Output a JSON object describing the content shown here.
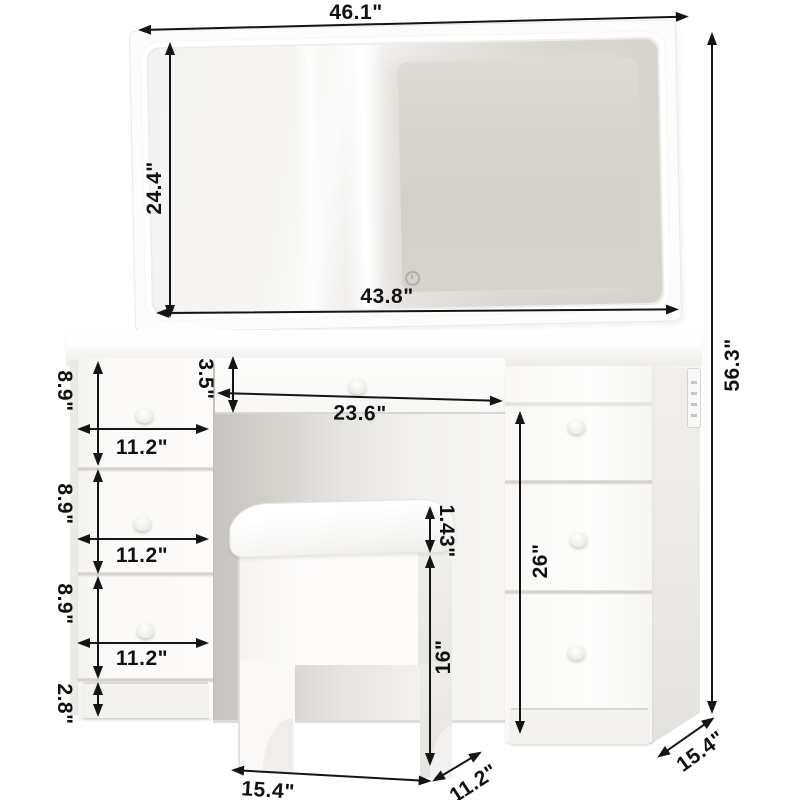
{
  "diagram": {
    "type": "furniture-dimension-diagram",
    "units": "inches"
  },
  "measurements": {
    "overall_width": "46.1\"",
    "overall_height": "56.3\"",
    "mirror_width": "43.8\"",
    "mirror_height": "24.4\"",
    "center_drawer_height": "3.5\"",
    "knee_space_width": "23.6\"",
    "left_drawer_height": "8.9\"",
    "left_drawer_width": "11.2\"",
    "left_base_height": "2.8\"",
    "right_unit_height": "26\"",
    "cushion_thickness": "1.43\"",
    "stool_height": "16\"",
    "stool_width": "15.4\"",
    "stool_depth": "11.2\"",
    "desk_depth": "15.4\""
  },
  "icons": {
    "mirror_touch": "power-touch-icon"
  },
  "colors": {
    "annotation": "#151515",
    "furniture_white": "#fbfaf9",
    "mirror_reflection": "#d6d2cc",
    "knee_shadow": "#c7c4c0"
  },
  "annotations": [
    {
      "id": "overall-width",
      "label": "46.1\"",
      "arrow": {
        "x": 139,
        "y": 30,
        "len": 549,
        "rot": -1.4
      },
      "text": {
        "x": 356,
        "y": 13,
        "rot": 0
      }
    },
    {
      "id": "mirror-height",
      "label": "24.4\"",
      "arrow": {
        "x": 170,
        "y": 43,
        "len": 274,
        "rot": 90
      },
      "text": {
        "x": 155,
        "y": 188,
        "rot": -90
      }
    },
    {
      "id": "mirror-width",
      "label": "43.8\"",
      "arrow": {
        "x": 157,
        "y": 313,
        "len": 521,
        "rot": -0.4
      },
      "text": {
        "x": 387,
        "y": 297,
        "rot": 0
      }
    },
    {
      "id": "center-drawer-height",
      "label": "3.5\"",
      "arrow": {
        "x": 233,
        "y": 357,
        "len": 55,
        "rot": 90
      },
      "text": {
        "x": 205,
        "y": 379,
        "rot": 90
      }
    },
    {
      "id": "knee-space-width",
      "label": "23.6\"",
      "arrow": {
        "x": 218,
        "y": 393,
        "len": 284,
        "rot": 1.6
      },
      "text": {
        "x": 360,
        "y": 414,
        "rot": 1
      }
    },
    {
      "id": "left-drawer1-height",
      "label": "8.9\"",
      "arrow": {
        "x": 98,
        "y": 362,
        "len": 103,
        "rot": 90
      },
      "text": {
        "x": 64,
        "y": 391,
        "rot": 90
      }
    },
    {
      "id": "left-drawer2-height",
      "label": "8.9\"",
      "arrow": {
        "x": 98,
        "y": 470,
        "len": 103,
        "rot": 90
      },
      "text": {
        "x": 64,
        "y": 504,
        "rot": 90
      }
    },
    {
      "id": "left-drawer3-height",
      "label": "8.9\"",
      "arrow": {
        "x": 98,
        "y": 577,
        "len": 101,
        "rot": 90
      },
      "text": {
        "x": 64,
        "y": 604,
        "rot": 90
      }
    },
    {
      "id": "left-base-height",
      "label": "2.8\"",
      "arrow": {
        "x": 98,
        "y": 683,
        "len": 33,
        "rot": 90
      },
      "text": {
        "x": 64,
        "y": 704,
        "rot": 90
      }
    },
    {
      "id": "left-drawer1-width",
      "label": "11.2\"",
      "arrow": {
        "x": 78,
        "y": 429,
        "len": 130,
        "rot": 0
      },
      "text": {
        "x": 142,
        "y": 448,
        "rot": 0
      }
    },
    {
      "id": "left-drawer2-width",
      "label": "11.2\"",
      "arrow": {
        "x": 78,
        "y": 539,
        "len": 130,
        "rot": 0
      },
      "text": {
        "x": 142,
        "y": 556,
        "rot": 0
      }
    },
    {
      "id": "left-drawer3-width",
      "label": "11.2\"",
      "arrow": {
        "x": 78,
        "y": 643,
        "len": 130,
        "rot": 0
      },
      "text": {
        "x": 142,
        "y": 659,
        "rot": 0
      }
    },
    {
      "id": "right-unit-height",
      "label": "26\"",
      "arrow": {
        "x": 520,
        "y": 412,
        "len": 321,
        "rot": 90
      },
      "text": {
        "x": 541,
        "y": 561,
        "rot": -90
      }
    },
    {
      "id": "overall-height",
      "label": "56.3\"",
      "arrow": {
        "x": 712,
        "y": 33,
        "len": 680,
        "rot": 90
      },
      "text": {
        "x": 733,
        "y": 365,
        "rot": -90
      }
    },
    {
      "id": "cushion-thickness",
      "label": "1.43\"",
      "arrow": {
        "x": 430,
        "y": 507,
        "len": 45,
        "rot": 90
      },
      "text": {
        "x": 446,
        "y": 531,
        "rot": 90
      }
    },
    {
      "id": "stool-height",
      "label": "16\"",
      "arrow": {
        "x": 430,
        "y": 556,
        "len": 209,
        "rot": 90
      },
      "text": {
        "x": 444,
        "y": 657,
        "rot": -90
      }
    },
    {
      "id": "stool-width",
      "label": "15.4\"",
      "arrow": {
        "x": 232,
        "y": 770,
        "len": 199,
        "rot": 3.2
      },
      "text": {
        "x": 268,
        "y": 791,
        "rot": 4
      }
    },
    {
      "id": "stool-depth",
      "label": "11.2\"",
      "arrow": {
        "x": 433,
        "y": 781,
        "len": 56,
        "rot": -31
      },
      "text": {
        "x": 474,
        "y": 784,
        "rot": -33
      }
    },
    {
      "id": "desk-depth",
      "label": "15.4\"",
      "arrow": {
        "x": 658,
        "y": 757,
        "len": 68,
        "rot": -35
      },
      "text": {
        "x": 701,
        "y": 752,
        "rot": -36
      }
    }
  ]
}
